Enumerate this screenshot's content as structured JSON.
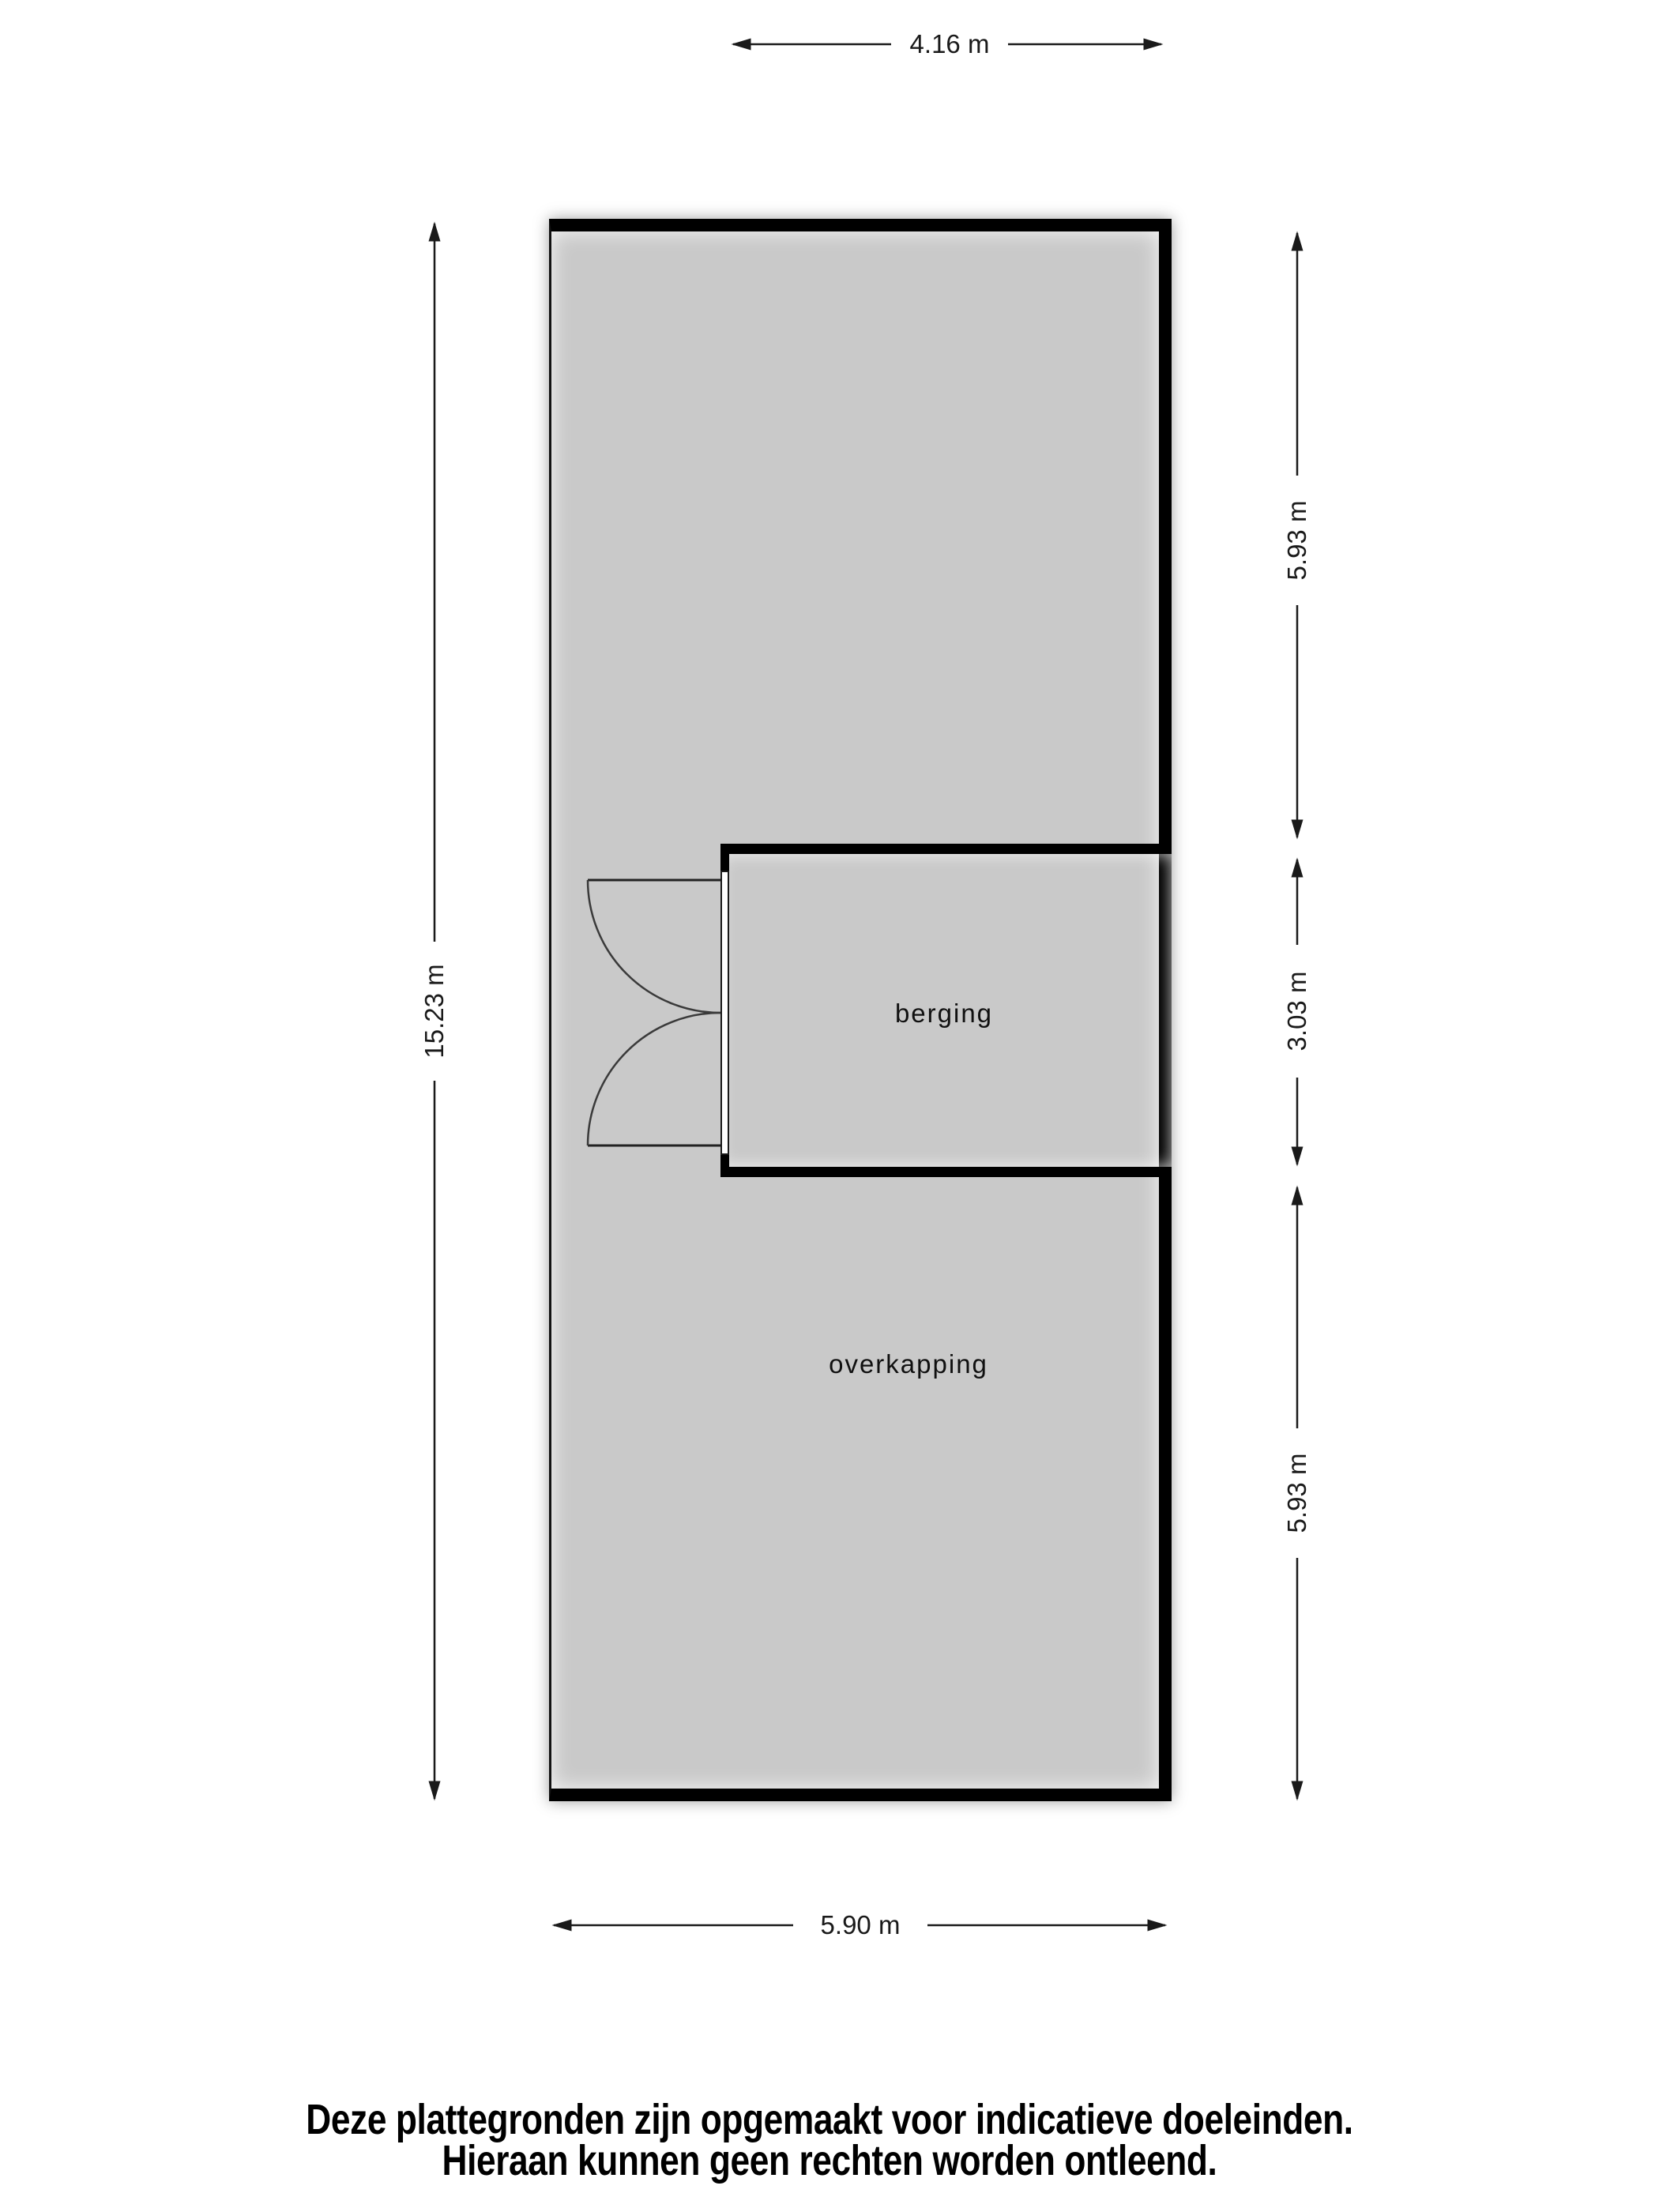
{
  "plan": {
    "rooms": [
      {
        "label": "berging"
      },
      {
        "label": "overkapping"
      }
    ],
    "dimensions": {
      "top": "4.16 m",
      "left": "15.23 m",
      "bottom": "5.90 m",
      "right_top": "5.93 m",
      "right_middle": "3.03 m",
      "right_bottom": "5.93 m"
    },
    "door": {
      "type": "double-swing"
    }
  },
  "disclaimer": {
    "line1": "Deze plattegronden zijn opgemaakt voor indicatieve doeleinden.",
    "line2": "Hieraan kunnen geen rechten worden ontleend."
  },
  "colors": {
    "floor_fill": "#c9c9c9",
    "wall": "#000000",
    "dimension_ink": "#1a1a1a",
    "background": "#ffffff"
  }
}
